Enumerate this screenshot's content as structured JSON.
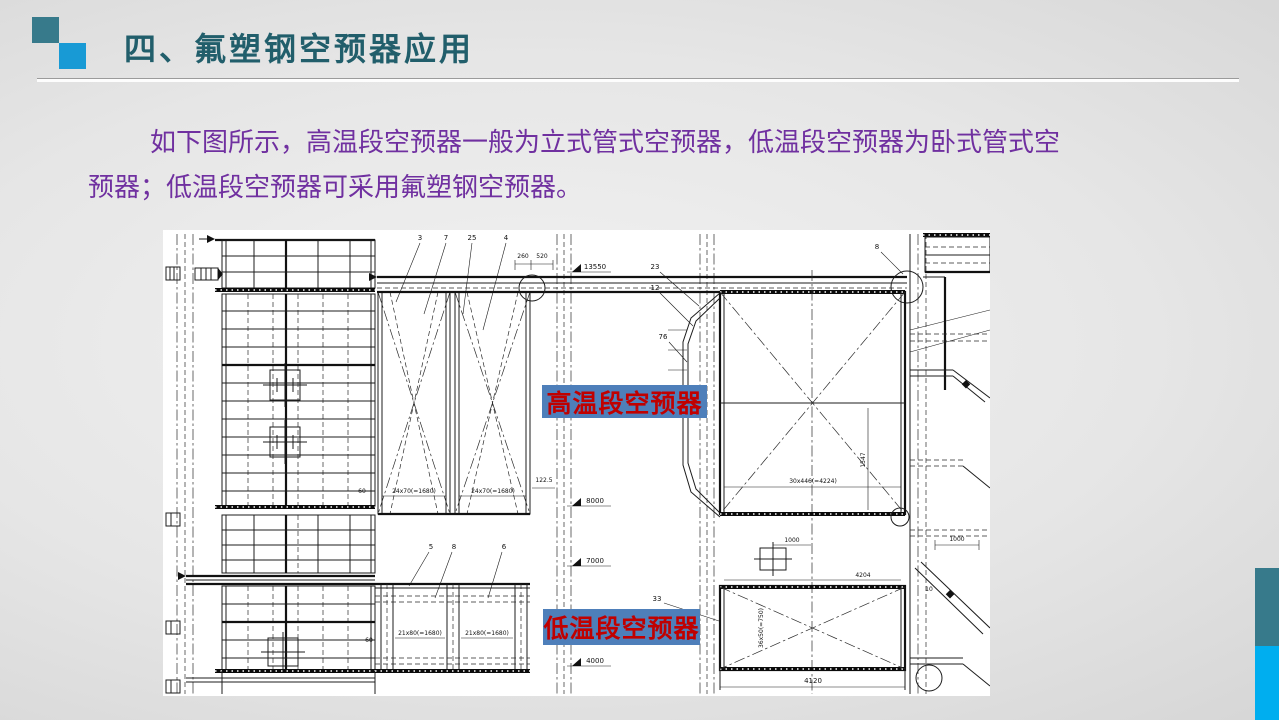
{
  "slide": {
    "title": "四、氟塑钢空预器应用",
    "body": {
      "line1": "如下图所示，高温段空预器一般为立式管式空预器，低温段空预器为卧式管式空",
      "line2": "预器；低温段空预器可采用氟塑钢空预器。"
    }
  },
  "diagram": {
    "label_high_temp": "高温段空预器",
    "label_low_temp": "低温段空预器",
    "part_numbers": {
      "n3": "3",
      "n7": "7",
      "n25": "25",
      "n4": "4",
      "n23": "23",
      "n12": "12",
      "n76": "76",
      "n8b": "8",
      "n5": "5",
      "n8": "8",
      "n6": "6",
      "n33": "33",
      "n10": "10"
    },
    "dims": {
      "d260": "260",
      "d520": "520",
      "d24a": "24x70(=1680)",
      "d24b": "24x70(=1680)",
      "d60a": "60",
      "d122": "122.5",
      "d30x": "30x446(=4224)",
      "d1547": "1547",
      "d1000a": "1000",
      "d1000b": "1000",
      "d4204": "4204",
      "d21a": "21x80(=1680)",
      "d21b": "21x80(=1680)",
      "d60b": "60",
      "d36": "36x50(=750)",
      "d4120": "4120"
    },
    "elevations": {
      "e13550": "13550",
      "e8000": "8000",
      "e7000": "7000",
      "e4000": "4000"
    }
  },
  "colors": {
    "title_teal": "#215E6B",
    "body_purple": "#7030A0",
    "accent_teal_square": "#377A8B",
    "accent_blue_square": "#189AD5",
    "strip_teal": "#377A8B",
    "strip_blue": "#00AEEF",
    "label_bg_blue": "#4E7FBA",
    "label_text_red": "#C00000",
    "drawing_bg": "#FFFFFF"
  }
}
